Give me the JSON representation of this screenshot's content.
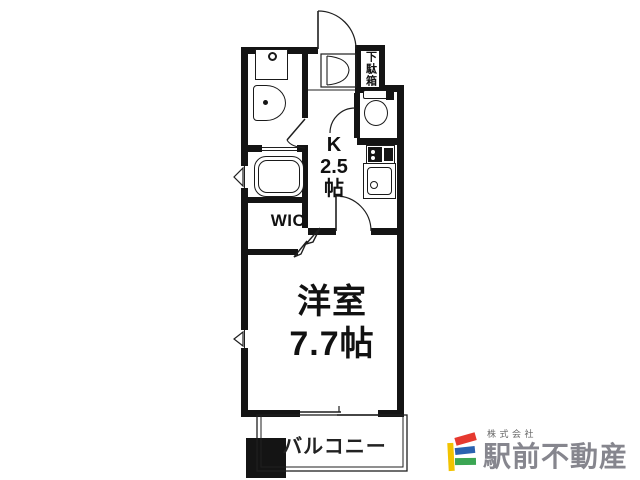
{
  "plan": {
    "labels": {
      "main_room": "洋室\n7.7帖",
      "kitchen": "K\n2.5\n帖",
      "wic": "WIC",
      "shoe_cabinet": "下駄箱",
      "balcony": "バルコニー"
    },
    "colors": {
      "wall": "#141414",
      "line": "#1f1f1f"
    }
  },
  "logo": {
    "company_type": "株式会社",
    "company_name": "駅前不動産",
    "colors": {
      "yellow": "#f2c300",
      "red": "#e6392f",
      "blue": "#2a62b0",
      "green": "#3ba653",
      "text": "#86868e"
    }
  }
}
